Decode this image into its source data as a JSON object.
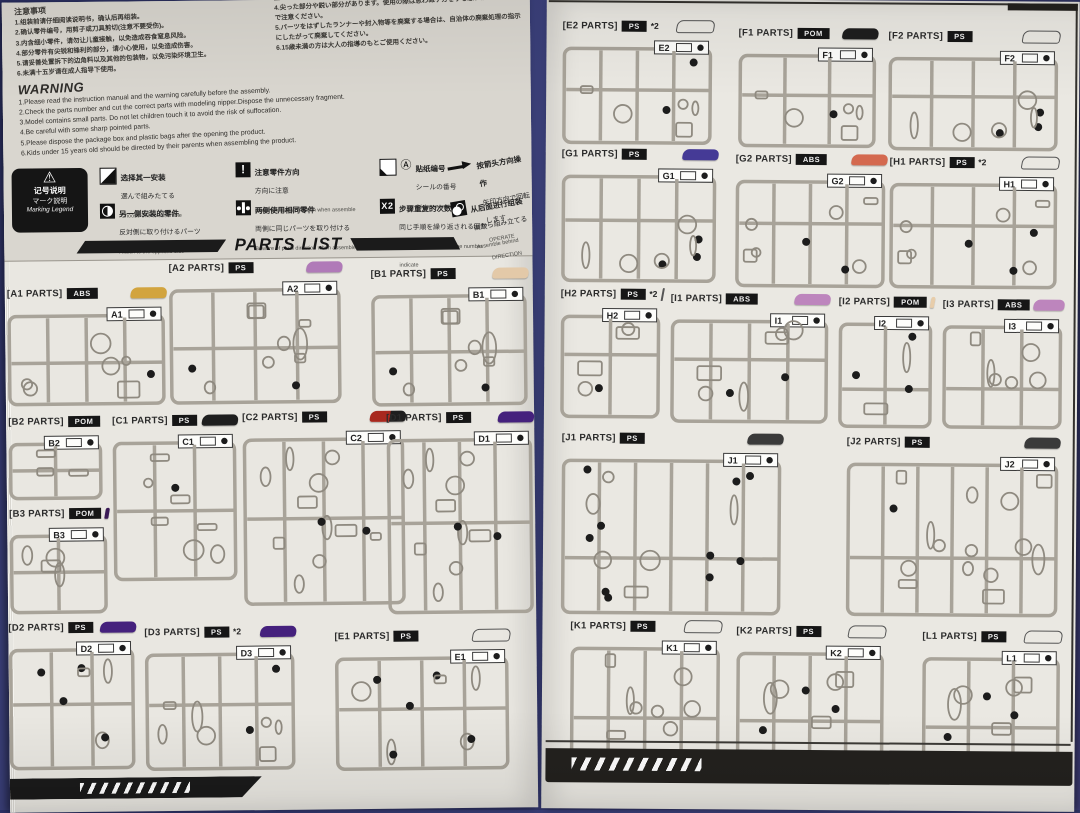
{
  "doc": {
    "type": "model-kit instruction manual — parts list spread",
    "parts_list_title": "PARTS LIST"
  },
  "warning_cn": {
    "title": "注意事项",
    "items": [
      "1.组装前请仔细阅读说明书，确认后再组装。",
      "2.确认零件编号，用剪子或刀具剪切(注意不要受伤)。",
      "3.内含细小零件，请勿让儿童接触，以免造成吞食窒息风险。",
      "4.部分零件有尖锐和锋利的部分，请小心使用，以免造成伤害。",
      "5.请妥善处置拆下的边角料以及其他的包装物，以免污染环境卫生。",
      "6.未满十五岁请在成人指导下使用。"
    ]
  },
  "warning_jp": {
    "lead": "窒息などの危険があります。",
    "items": [
      "4.尖った部分や鋭い部分があります。使用の際は思わぬケガをする恐れがありますので注意ください。",
      "5.パーツをはずしたランナーや封入物等を廃棄する場合は、自治体の廃棄処理の指示にしたがって廃棄してください。",
      "6.15歳未満の方は大人の指導のもとご使用ください。"
    ]
  },
  "warning_en": {
    "title": "WARNING",
    "items": [
      "1.Please read the instruction manual and the warning carefully before the assembly.",
      "2.Check the parts number and cut the correct parts with modeling nipper.Dispose the unnecessary fragment.",
      "3.Model contains small parts. Do not let children touch it to avoid the risk of suffocation.",
      "4.Be careful with some sharp pointed parts.",
      "5.Please dispose the package box and plastic bags after the opening the product.",
      "6.Kids under 15 years old should be directed by their parents when assembling the product."
    ]
  },
  "legend": {
    "box": {
      "cn": "记号说明",
      "jp": "マーク説明",
      "en": "Marking Legend"
    },
    "items": [
      {
        "icon": "choose-one-icon",
        "cn": "选择其一安装",
        "jp": "選んで組みたてる",
        "en": "Choose one to assemble"
      },
      {
        "icon": "opposite-side-icon",
        "cn": "另一侧安装的零件",
        "jp": "反対側に取り付けるパーツ",
        "en": "Attach to the opposite side"
      },
      {
        "icon": "caution-direction-icon",
        "cn": "注意零件方向",
        "jp": "方向に注意",
        "en": "Beware of parts direction when assemble"
      },
      {
        "icon": "same-both-sides-icon",
        "cn": "两侧使用相同零件",
        "jp": "両側に同じパーツを取り付ける",
        "en": "Beware of parts direction when assemble"
      },
      {
        "icon": "sticker-number-icon",
        "cn": "贴纸编号",
        "jp": "シールの番号",
        "en": "Sticker number"
      },
      {
        "icon": "x2-icon",
        "cn": "步骤重复的次数",
        "jp": "同じ手順を繰り返される回数",
        "en": "Assemble as many as the number indicate"
      },
      {
        "icon": "operate-arrow-icon",
        "cn": "按箭头方向操作",
        "jp": "矢印方向で回転します",
        "en": "OPERATE DIRECTION"
      },
      {
        "icon": "assemble-behind-icon",
        "cn": "从后面进行组装",
        "jp": "後から組み立てる",
        "en": "Assemble behind"
      }
    ]
  },
  "colors": {
    "gold": "#d2a43e",
    "light_purple": "#b07ab8",
    "tan": "#e3c9a8",
    "black": "#1e1e1e",
    "dark_purple": "#45217d",
    "deep_purple": "#3a1a55",
    "blue_purple": "#453a96",
    "salmon_red": "#d4694f",
    "lavender": "#bd85bd",
    "beige": "#e8cdaa",
    "dark_gray": "#3a3a3a",
    "red_black": "red-black",
    "clear": "clear"
  },
  "runners": {
    "left": [
      {
        "code": "A1",
        "label": "[A1 PARTS]",
        "material": "ABS",
        "mult": "",
        "chip": "#d2a43e",
        "x": 2,
        "y": 26,
        "w": 160,
        "h": 122
      },
      {
        "code": "A2",
        "label": "[A2 PARTS]",
        "material": "PS",
        "mult": "",
        "chip": "#b07ab8",
        "x": 164,
        "y": 2,
        "w": 174,
        "h": 146
      },
      {
        "code": "B1",
        "label": "[B1 PARTS]",
        "material": "PS",
        "mult": "",
        "chip": "#e3c9a8",
        "x": 366,
        "y": 10,
        "w": 158,
        "h": 142
      },
      {
        "code": "B2",
        "label": "[B2 PARTS]",
        "material": "POM",
        "mult": "",
        "chip": "#1e1e1e",
        "x": 2,
        "y": 154,
        "w": 96,
        "h": 88
      },
      {
        "code": "C1",
        "label": "[C1 PARTS]",
        "material": "PS",
        "mult": "",
        "chip": "#1e1e1e",
        "x": 106,
        "y": 154,
        "w": 126,
        "h": 170
      },
      {
        "code": "C2",
        "label": "[C2 PARTS]",
        "material": "PS",
        "mult": "",
        "chip": "red-black",
        "x": 236,
        "y": 152,
        "w": 164,
        "h": 198
      },
      {
        "code": "D1",
        "label": "[D1 PARTS]",
        "material": "PS",
        "mult": "",
        "chip": "#45217d",
        "x": 380,
        "y": 154,
        "w": 148,
        "h": 206
      },
      {
        "code": "B3",
        "label": "[B3 PARTS]",
        "material": "POM",
        "mult": "",
        "chip": "#3a1a55",
        "x": 2,
        "y": 246,
        "w": 100,
        "h": 110
      },
      {
        "code": "D2",
        "label": "[D2 PARTS]",
        "material": "PS",
        "mult": "",
        "chip": "#45217d",
        "x": 0,
        "y": 360,
        "w": 128,
        "h": 152
      },
      {
        "code": "D3",
        "label": "[D3 PARTS]",
        "material": "PS",
        "mult": "*2",
        "chip": "#45217d",
        "x": 136,
        "y": 366,
        "w": 152,
        "h": 148
      },
      {
        "code": "E1",
        "label": "[E1 PARTS]",
        "material": "PS",
        "mult": "",
        "chip": "clear",
        "x": 326,
        "y": 372,
        "w": 176,
        "h": 144
      }
    ],
    "right": [
      {
        "code": "E2",
        "label": "[E2 PARTS]",
        "material": "PS",
        "mult": "*2",
        "chip": "clear",
        "x": 16,
        "y": 12,
        "w": 152,
        "h": 128
      },
      {
        "code": "F1",
        "label": "[F1 PARTS]",
        "material": "POM",
        "mult": "",
        "chip": "#1e1e1e",
        "x": 192,
        "y": 18,
        "w": 140,
        "h": 124
      },
      {
        "code": "F2",
        "label": "[F2 PARTS]",
        "material": "PS",
        "mult": "",
        "chip": "clear",
        "x": 342,
        "y": 20,
        "w": 172,
        "h": 124
      },
      {
        "code": "G1",
        "label": "[G1 PARTS]",
        "material": "PS",
        "mult": "",
        "chip": "#453a96",
        "x": 16,
        "y": 140,
        "w": 157,
        "h": 138
      },
      {
        "code": "G2",
        "label": "[G2 PARTS]",
        "material": "ABS",
        "mult": "",
        "chip": "#d4694f",
        "x": 190,
        "y": 144,
        "w": 152,
        "h": 138
      },
      {
        "code": "H1",
        "label": "[H1 PARTS]",
        "material": "PS",
        "mult": "*2",
        "chip": "clear",
        "x": 344,
        "y": 146,
        "w": 170,
        "h": 136
      },
      {
        "code": "H2",
        "label": "[H2 PARTS]",
        "material": "PS",
        "mult": "*2",
        "chip": "clear",
        "x": 16,
        "y": 280,
        "w": 102,
        "h": 134
      },
      {
        "code": "I1",
        "label": "[I1 PARTS]",
        "material": "ABS",
        "mult": "",
        "chip": "#bd85bd",
        "x": 126,
        "y": 284,
        "w": 160,
        "h": 134
      },
      {
        "code": "I2",
        "label": "[I2 PARTS]",
        "material": "POM",
        "mult": "",
        "chip": "#e8cdaa",
        "x": 294,
        "y": 286,
        "w": 96,
        "h": 136
      },
      {
        "code": "I3",
        "label": "[I3 PARTS]",
        "material": "ABS",
        "mult": "",
        "chip": "#bd85bd",
        "x": 398,
        "y": 288,
        "w": 122,
        "h": 134
      },
      {
        "code": "J1",
        "label": "[J1 PARTS]",
        "material": "PS",
        "mult": "",
        "chip": "#3a3a3a",
        "x": 18,
        "y": 424,
        "w": 222,
        "h": 186
      },
      {
        "code": "J2",
        "label": "[J2 PARTS]",
        "material": "PS",
        "mult": "",
        "chip": "#3a3a3a",
        "x": 303,
        "y": 426,
        "w": 214,
        "h": 184
      },
      {
        "code": "K1",
        "label": "[K1 PARTS]",
        "material": "PS",
        "mult": "",
        "chip": "clear",
        "x": 28,
        "y": 612,
        "w": 152,
        "h": 146
      },
      {
        "code": "K2",
        "label": "[K2 PARTS]",
        "material": "PS",
        "mult": "",
        "chip": "clear",
        "x": 194,
        "y": 616,
        "w": 150,
        "h": 146
      },
      {
        "code": "L1",
        "label": "[L1 PARTS]",
        "material": "PS",
        "mult": "",
        "chip": "clear",
        "x": 380,
        "y": 620,
        "w": 140,
        "h": 148
      }
    ]
  }
}
